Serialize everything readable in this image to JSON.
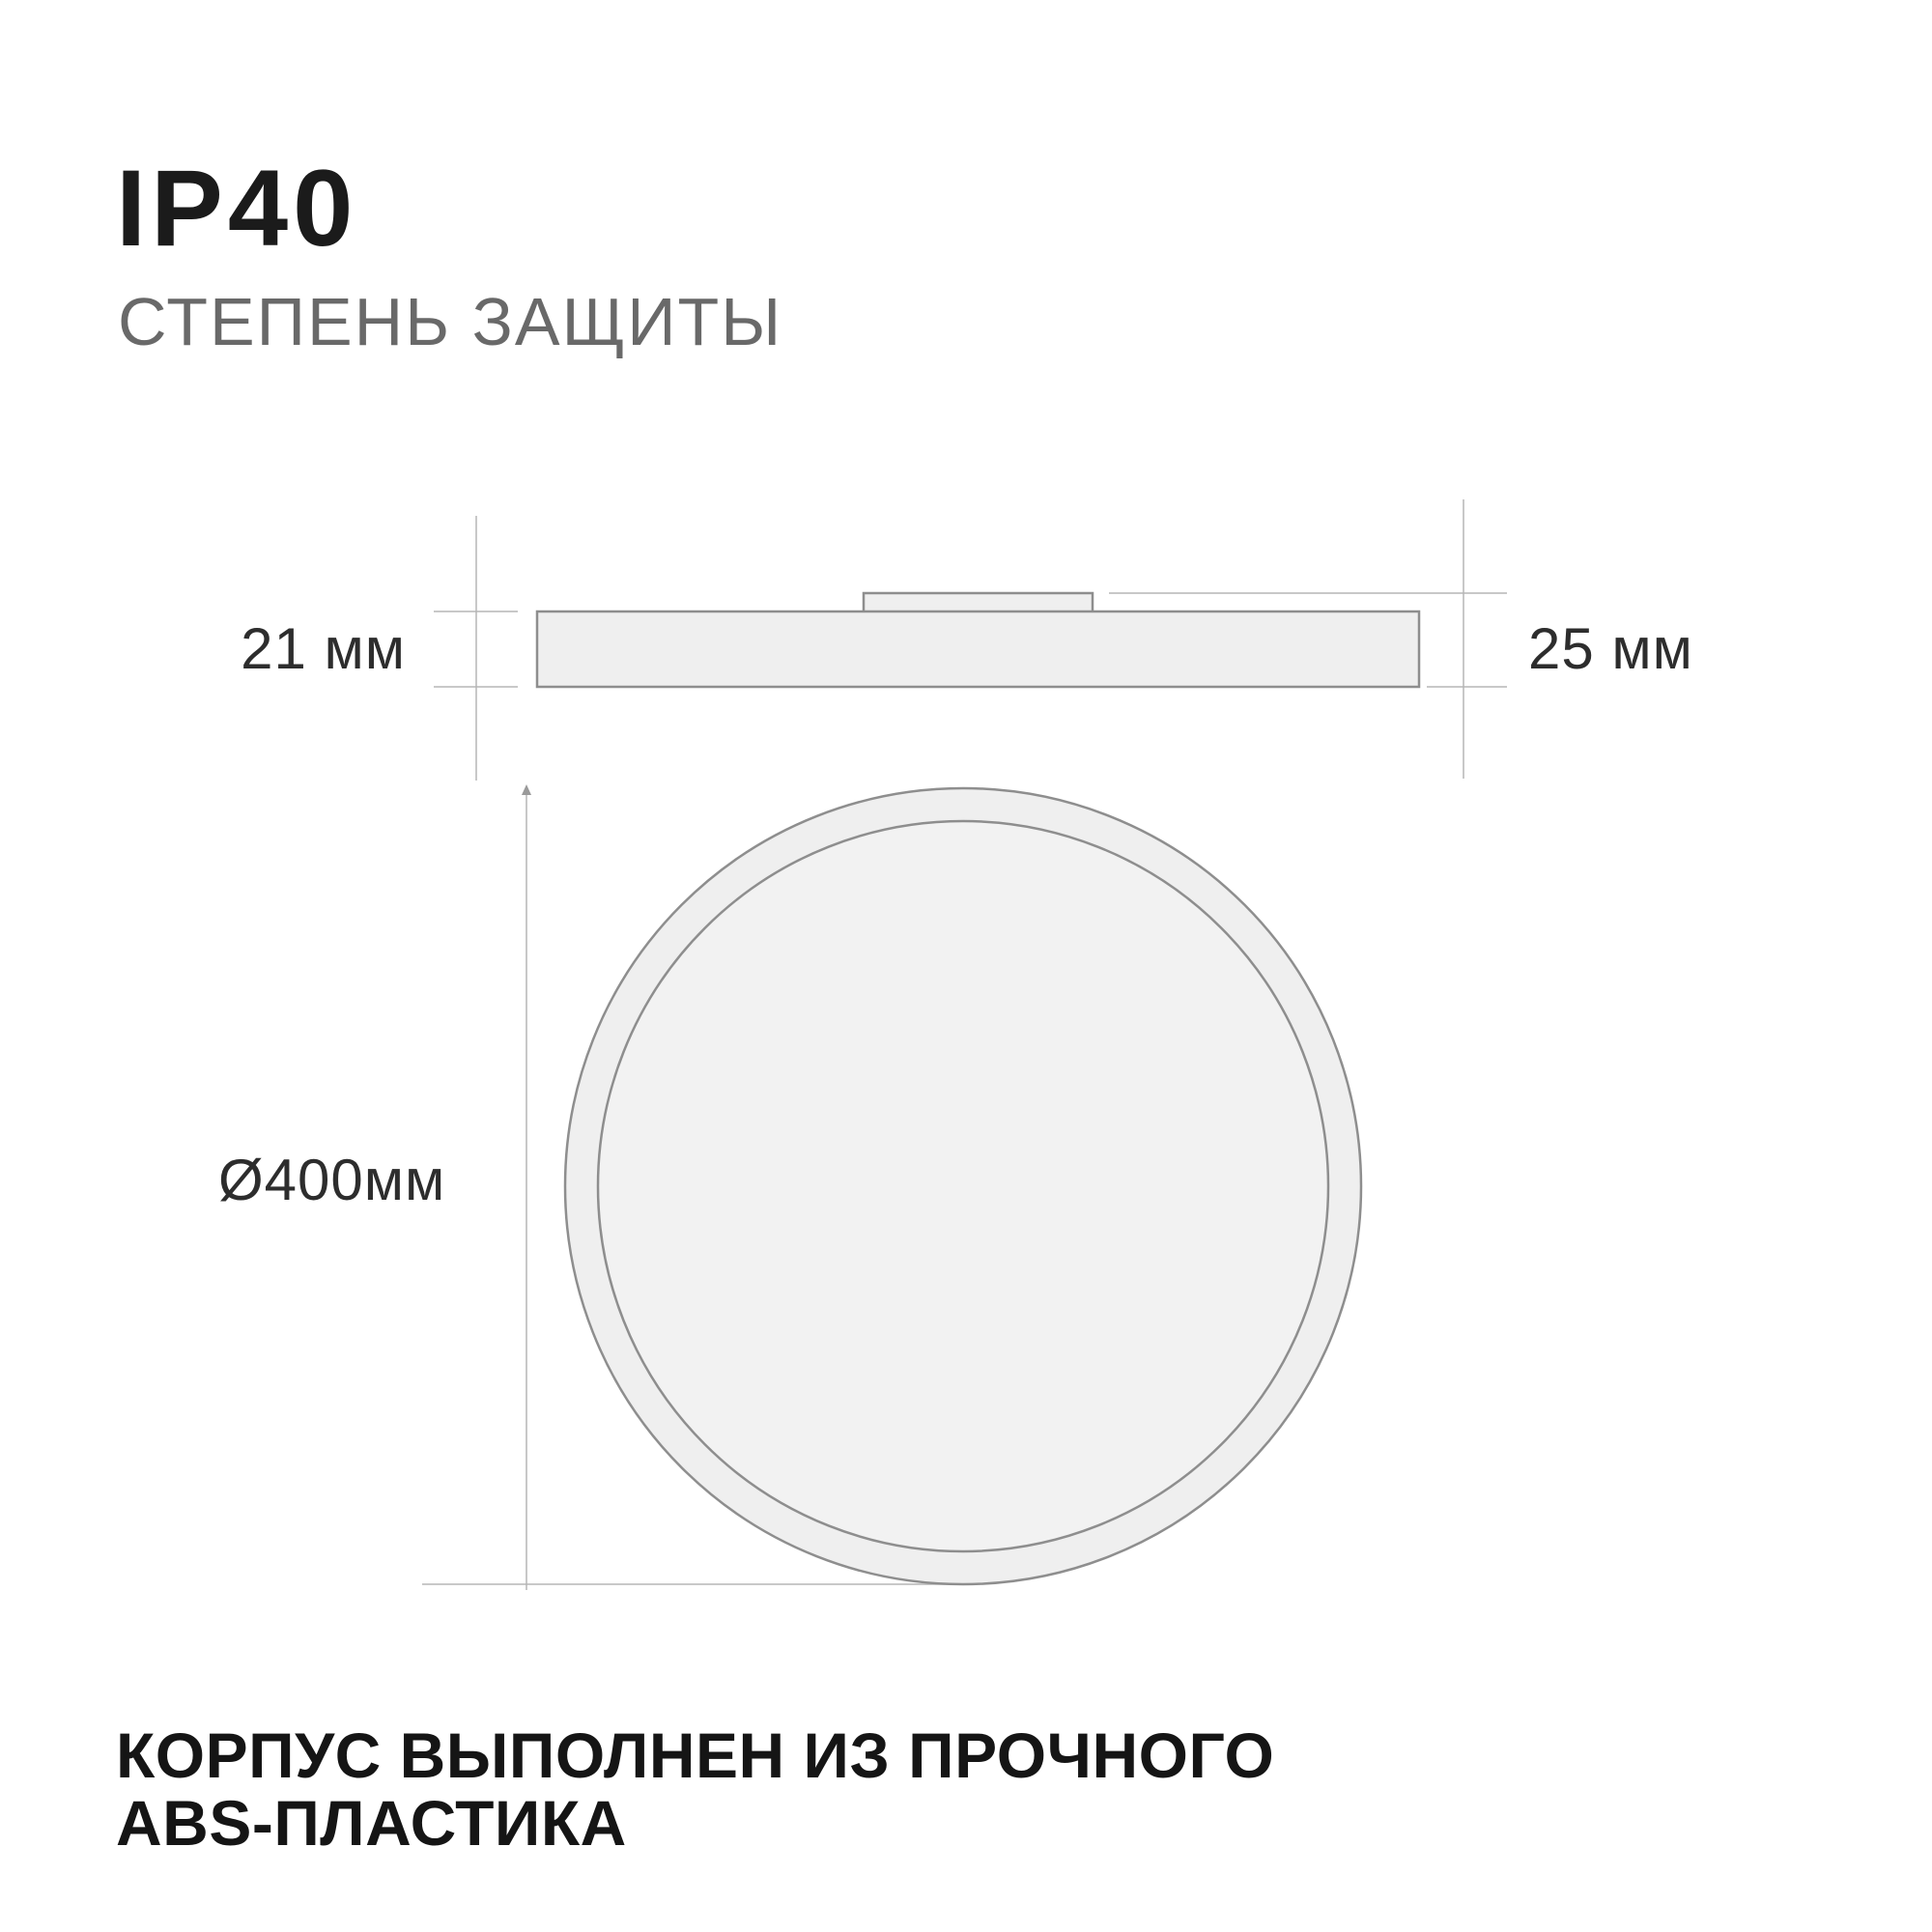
{
  "header": {
    "title": "IP40",
    "subtitle": "СТЕПЕНЬ ЗАЩИТЫ"
  },
  "diagram": {
    "side_view": {
      "body_height_label": "21 мм",
      "overall_height_label": "25 мм"
    },
    "top_view": {
      "diameter_label": "Ø400мм"
    }
  },
  "footer": {
    "line1": "КОРПУС ВЫПОЛНЕН ИЗ ПРОЧНОГО",
    "line2": "ABS-ПЛАСТИКА"
  },
  "colors": {
    "background": "#ffffff",
    "title": "#1b1b1b",
    "subtitle": "#696969",
    "dimension_label": "#2d2d2d",
    "footer": "#151515",
    "shape_fill": "#efefef",
    "inner_fill": "#f2f2f2",
    "shape_stroke": "#8e8e8e",
    "dim_line": "#b5b5b5"
  }
}
